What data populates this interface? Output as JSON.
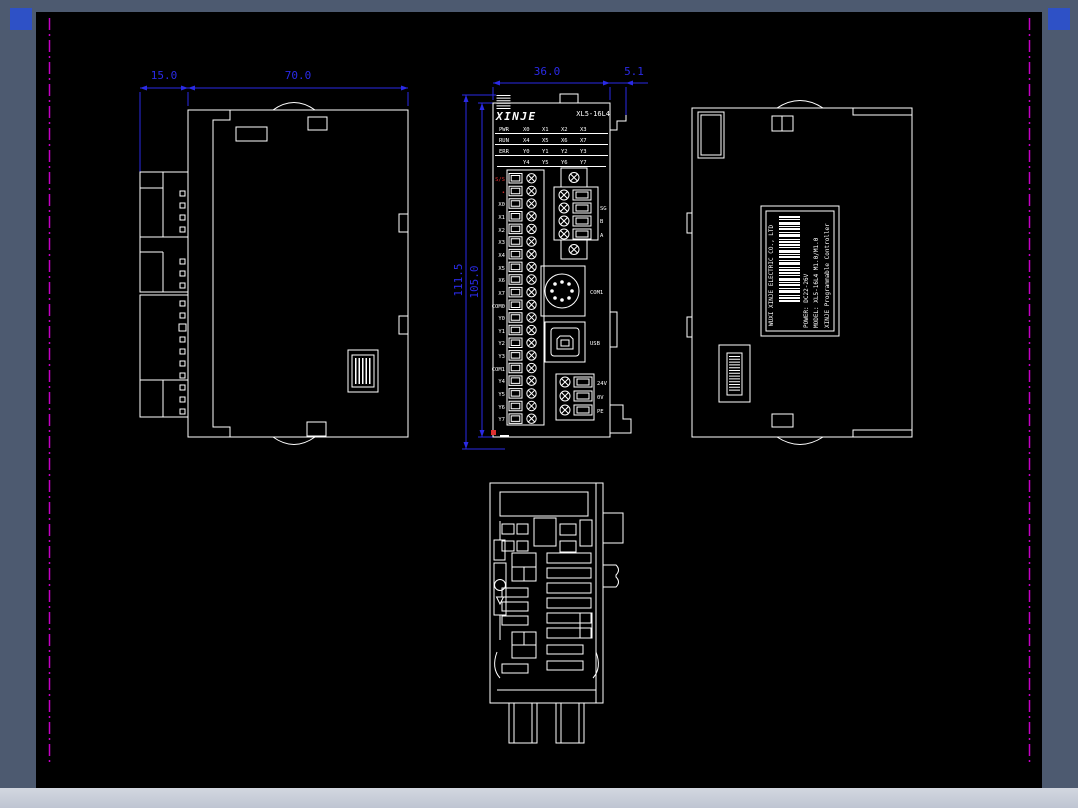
{
  "app": {
    "type": "cad-drawing-view",
    "colors": {
      "frame": "#4d5a70",
      "canvas": "#000000",
      "line": "#ffffff",
      "dimension": "#2a2ae6",
      "border": "#c400c4",
      "alert": "#e03030",
      "bottom_bar": "#c8cdd8",
      "corner_button": "#2e51c6"
    }
  },
  "dimensions": {
    "side_clip_width": "15.0",
    "side_body_width": "70.0",
    "front_width": "36.0",
    "clip_offset": "5.1",
    "overall_height": "111.5",
    "body_height": "105.0"
  },
  "front": {
    "brand": "XINJE",
    "model": "XL5-16L4",
    "led_rows": [
      [
        "PWR",
        "X0",
        "X1",
        "X2",
        "X3"
      ],
      [
        "RUN",
        "X4",
        "X5",
        "X6",
        "X7"
      ],
      [
        "ERR",
        "Y0",
        "Y1",
        "Y2",
        "Y3"
      ],
      [
        "",
        "Y4",
        "Y5",
        "Y6",
        "Y7"
      ]
    ],
    "terminals": [
      "S/S",
      "•",
      "X0",
      "X1",
      "X2",
      "X3",
      "X4",
      "X5",
      "X6",
      "X7",
      "COM0",
      "Y0",
      "Y1",
      "Y2",
      "Y3",
      "COM1",
      "Y4",
      "Y5",
      "Y6",
      "Y7"
    ],
    "rs485_labels": [
      "SG",
      "B",
      "A"
    ],
    "com_label": "COM1",
    "usb_label": "USB",
    "power_labels": [
      "24V",
      "0V",
      "PE"
    ]
  },
  "nameplate": {
    "line1": "XINJE  Programmable Controller",
    "line2": "MODEL: XL5-16L4    M1.0/M1.0",
    "line3": "POWER: DC22-26V",
    "line4": "WUXI XINJE ELECTRIC CO., LTD"
  }
}
